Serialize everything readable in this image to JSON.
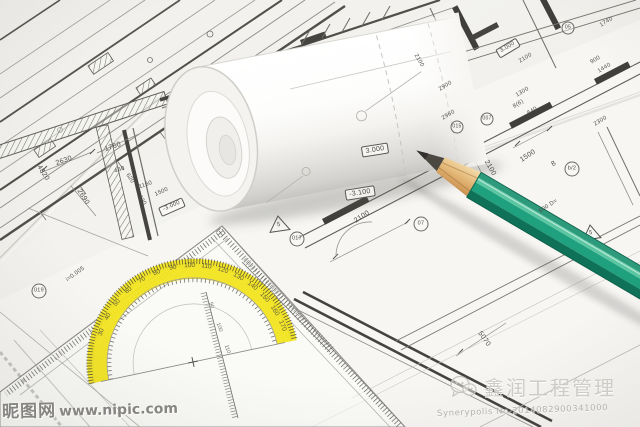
{
  "watermark_left": {
    "site_name": "昵图网",
    "site_url": "www.nipic.com"
  },
  "watermark_right": {
    "company": "鑫润工程管理",
    "serial": "Synerypolis No.2014082900341000"
  },
  "plan": {
    "labels": [
      "3.000",
      "-3.100",
      "2100",
      "-3.000",
      "1500",
      "2100",
      "1500",
      "8",
      "b/2",
      "500 D=",
      "017",
      "07",
      "019",
      "i=0.005",
      "5",
      "5",
      "3.000",
      "2100",
      "2900",
      "2960",
      "015",
      "007",
      "8(6)",
      "1300",
      "640",
      "2300",
      "1740",
      "05",
      "2630",
      "1760",
      "2690",
      "4820",
      "460",
      "620",
      "1160",
      "830",
      "5070",
      "2100",
      "900",
      "1440"
    ]
  },
  "protractor": {
    "degrees": [
      "30",
      "40",
      "50",
      "60",
      "70",
      "80",
      "90",
      "100",
      "110",
      "120",
      "130",
      "140",
      "150",
      "160",
      "170"
    ],
    "inner_scale": [
      "90",
      "100",
      "110"
    ]
  },
  "colors": {
    "pencil_green": "#1fa07e",
    "pencil_dark": "#0f7258",
    "wood": "#e4b878",
    "protractor_yellow": "#f2e41f",
    "paper": "#f4f3f0",
    "ink": "#4c4b47"
  }
}
